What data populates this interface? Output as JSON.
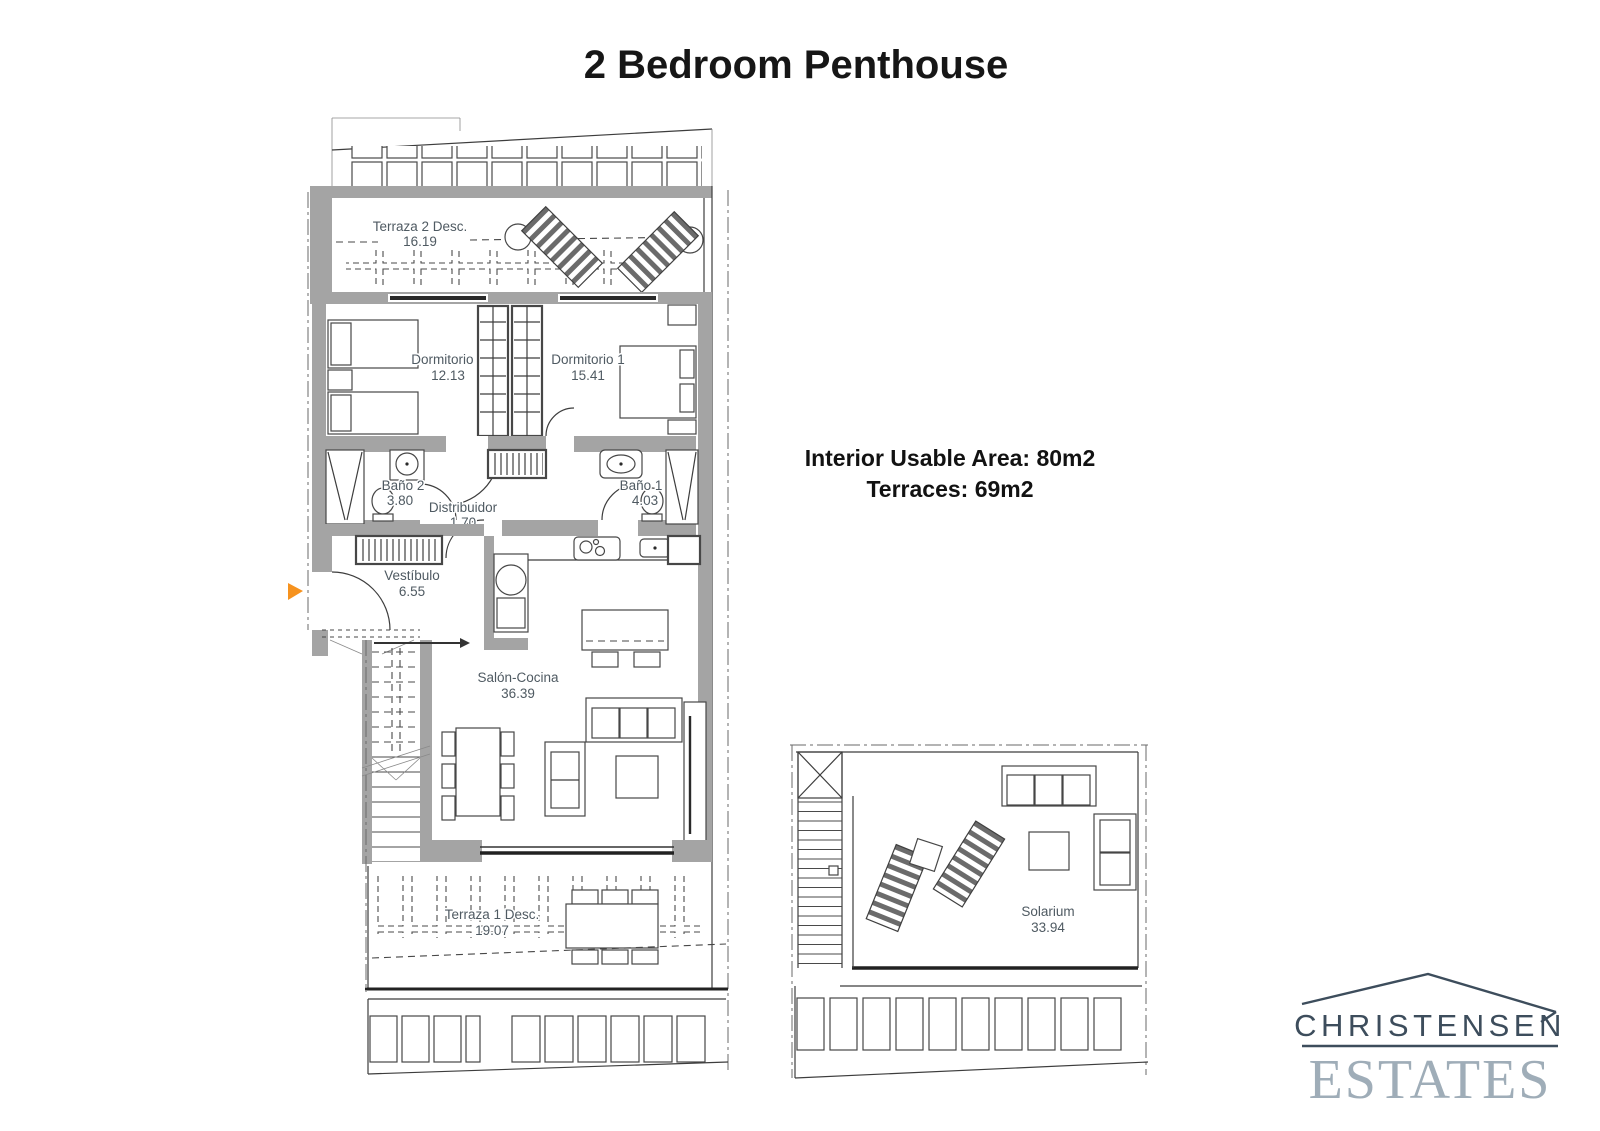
{
  "page": {
    "title": "2 Bedroom Penthouse"
  },
  "summary": {
    "interior": "Interior Usable Area: 80m2",
    "terraces": "Terraces: 69m2"
  },
  "rooms": {
    "terraza2": {
      "name": "Terraza 2 Desc.",
      "area": "16.19"
    },
    "dormitorio2": {
      "name": "Dormitorio 2",
      "area": "12.13"
    },
    "dormitorio1": {
      "name": "Dormitorio 1",
      "area": "15.41"
    },
    "bano2": {
      "name": "Baño 2",
      "area": "3.80"
    },
    "bano1": {
      "name": "Baño 1",
      "area": "4.03"
    },
    "distribuidor": {
      "name": "Distribuidor",
      "area": "1.70"
    },
    "vestibulo": {
      "name": "Vestíbulo",
      "area": "6.55"
    },
    "salon": {
      "name": "Salón-Cocina",
      "area": "36.39"
    },
    "terraza1": {
      "name": "Terraza 1 Desc.",
      "area": "19.07"
    },
    "solarium": {
      "name": "Solarium",
      "area": "33.94"
    }
  },
  "logo": {
    "name": "CHRISTENSEN",
    "type": "ESTATES"
  },
  "colors": {
    "wall": "#a4a4a4",
    "line": "#3d3d3d",
    "label": "#4f5a62",
    "entrance_arrow": "#f6921e",
    "logo_primary": "#3d4d5c",
    "logo_secondary": "#9fadb8"
  }
}
